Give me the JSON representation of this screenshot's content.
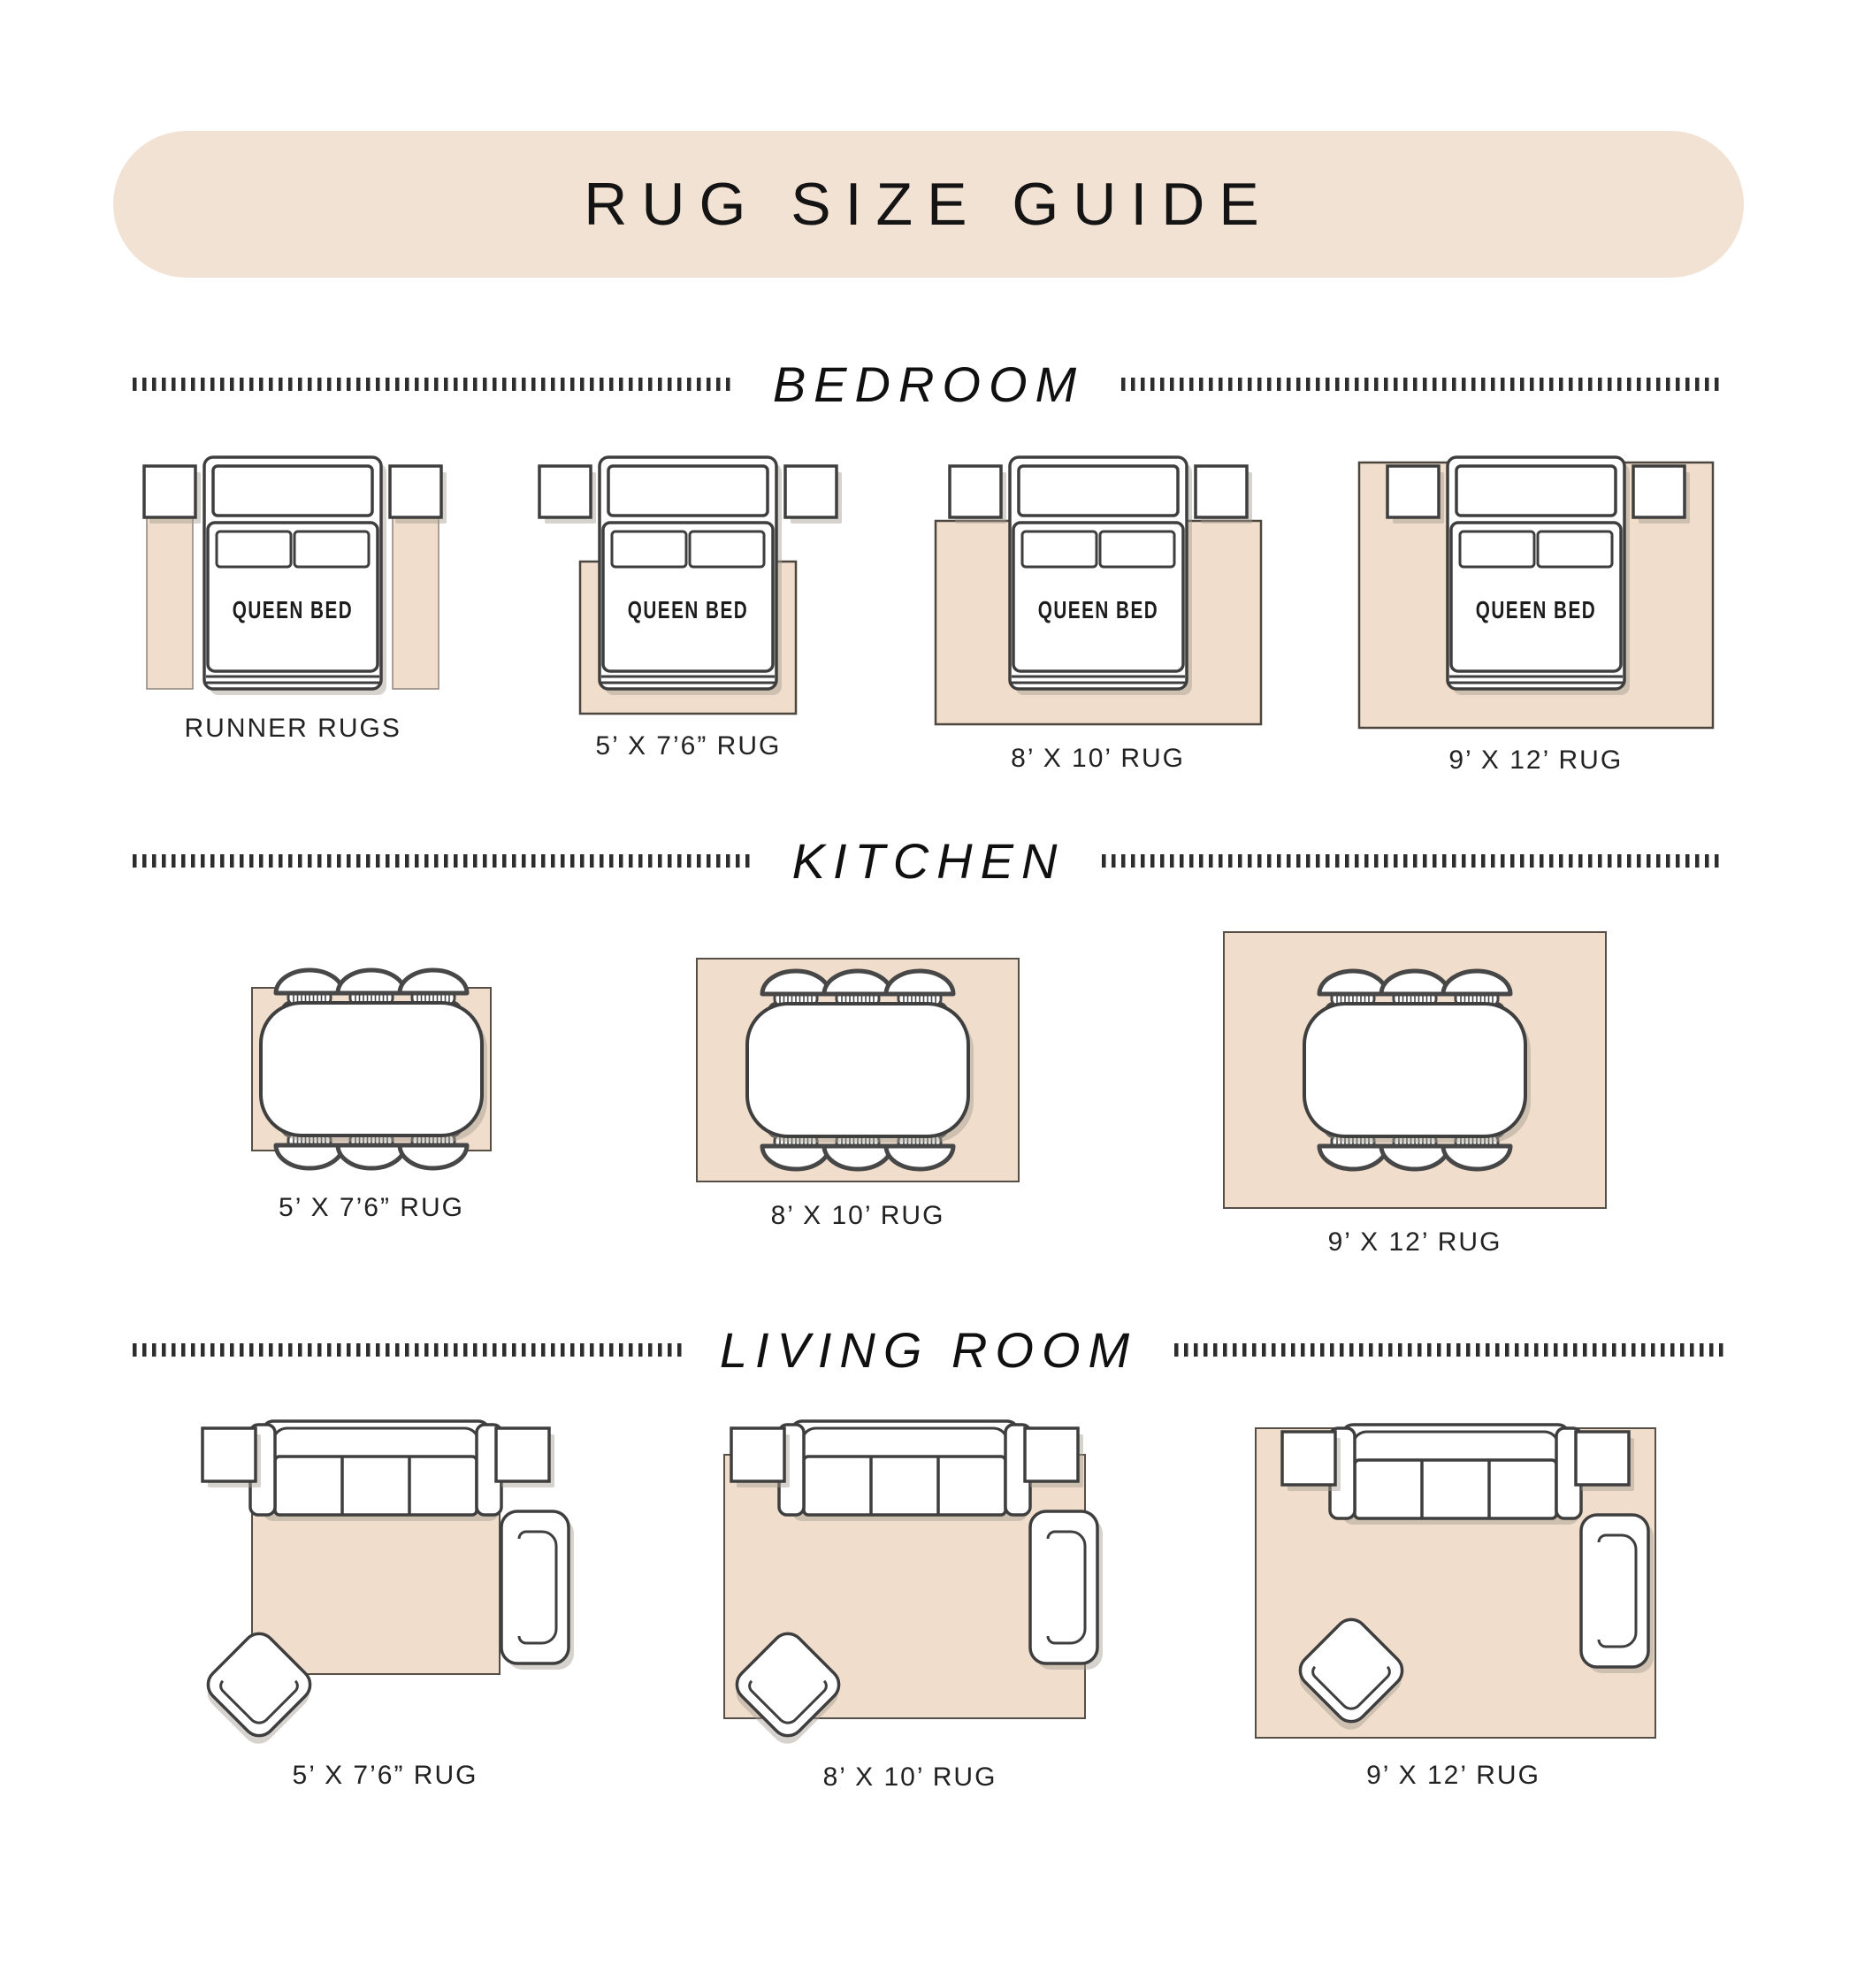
{
  "title": "RUG SIZE GUIDE",
  "bed_label": "QUEEN BED",
  "colors": {
    "banner": "#f2e2d3",
    "rug": "#f0ddcb",
    "rug_stroke": "#554f48",
    "runner_stroke": "#8d857b",
    "outline": "#3e3e3e",
    "shadow": "#a59d92",
    "dots": "#2d2d2d",
    "text": "#1f1f1f"
  },
  "sections": [
    {
      "name": "BEDROOM",
      "room": "bedroom",
      "items": [
        {
          "label": "RUNNER RUGS",
          "variant": "runner"
        },
        {
          "label": "5’ X 7’6” RUG",
          "variant": "5x76"
        },
        {
          "label": "8’ X 10’ RUG",
          "variant": "8x10"
        },
        {
          "label": "9’ X 12’ RUG",
          "variant": "9x12"
        }
      ]
    },
    {
      "name": "KITCHEN",
      "room": "kitchen",
      "items": [
        {
          "label": "5’ X 7’6” RUG",
          "variant": "5x76"
        },
        {
          "label": "8’ X 10’ RUG",
          "variant": "8x10"
        },
        {
          "label": "9’ X 12’ RUG",
          "variant": "9x12"
        }
      ]
    },
    {
      "name": "LIVING ROOM",
      "room": "living",
      "items": [
        {
          "label": "5’ X 7’6” RUG",
          "variant": "5x76"
        },
        {
          "label": "8’ X 10’ RUG",
          "variant": "8x10"
        },
        {
          "label": "9’ X 12’ RUG",
          "variant": "9x12"
        }
      ]
    }
  ]
}
